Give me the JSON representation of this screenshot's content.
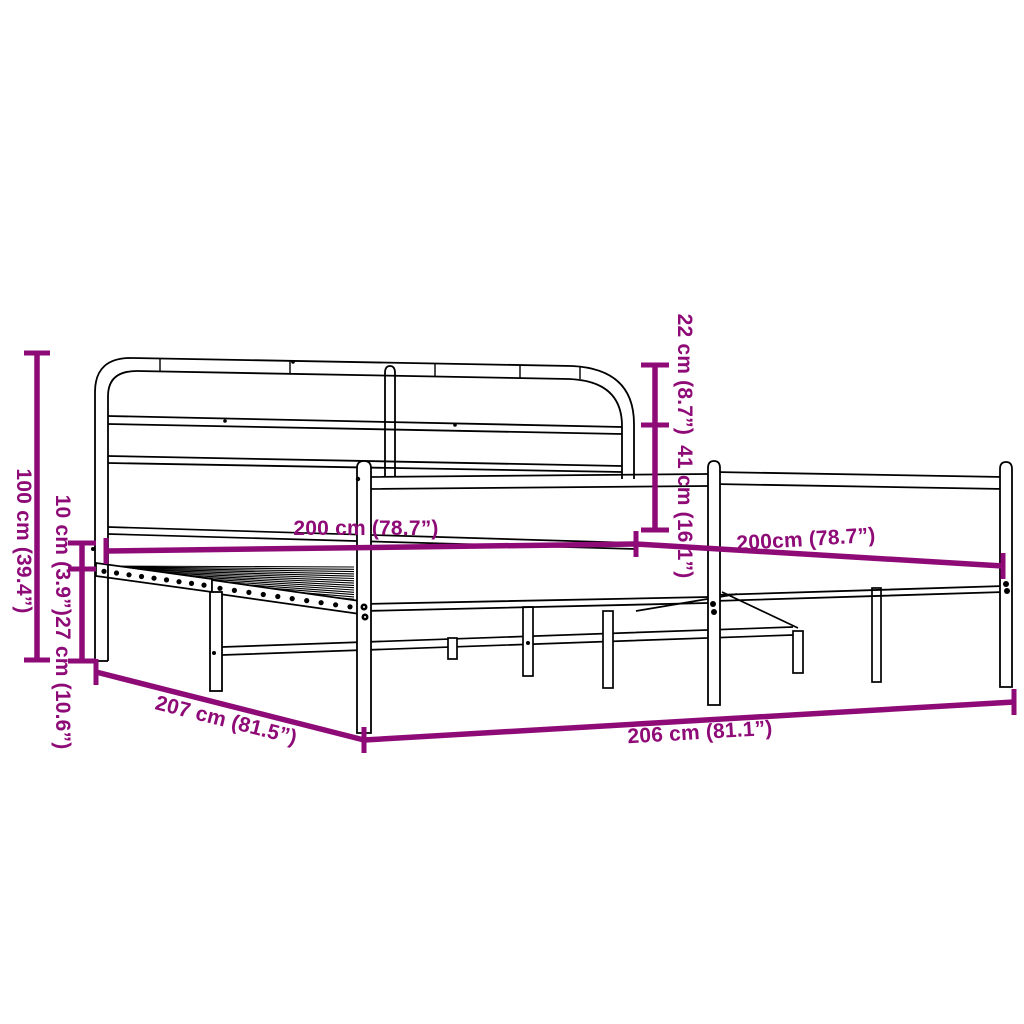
{
  "page": {
    "background": "#FFFFFF",
    "accent_color": "#8E0A77",
    "line_color": "#000000",
    "subject": "metal bed frame line drawing with dimension annotations"
  },
  "dimensions": {
    "overall_height": "100 cm (39.4”)",
    "frame_thickness": "10 cm (3.9”)",
    "under_bed_clearance": "27 cm (10.6”)",
    "headboard_top_section": "22 cm (8.7”)",
    "headboard_lower_section": "41 cm (16.1”)",
    "bed_length_inner": "200 cm (78.7”)",
    "bed_width_inner": "200cm (78.7”)",
    "frame_depth_outer": "207 cm (81.5”)",
    "frame_width_outer": "206 cm (81.1”)"
  }
}
